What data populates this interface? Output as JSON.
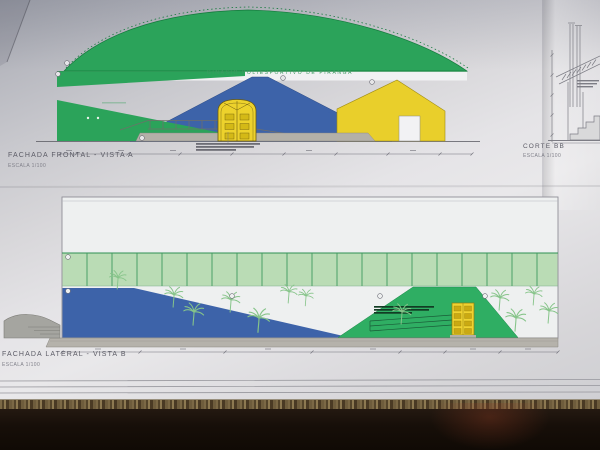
{
  "drawings": {
    "frontal": {
      "label": "FACHADA FRONTAL - VISTA A",
      "scale": "ESCALA 1/100",
      "building_title": "GINÁSIO POLIESPORTIVO DE PIRANGA"
    },
    "lateral": {
      "label": "FACHADA LATERAL - VISTA B",
      "scale": "ESCALA 1/100"
    },
    "section": {
      "label": "CORTE BB",
      "scale": "ESCALA 1/100"
    }
  },
  "colors": {
    "dome_green": "#2ba35a",
    "wall_blue": "#3d63a9",
    "detail_yellow": "#e9cf2b",
    "panel_band_green": "#badcb5",
    "hill_green": "#2fae63",
    "palm_green": "#86c489",
    "paper_gray": "#d9d9dc",
    "table_brown": "#5e4c30",
    "shadow_black": "#17100b",
    "ink_gray": "#6f6f76"
  }
}
